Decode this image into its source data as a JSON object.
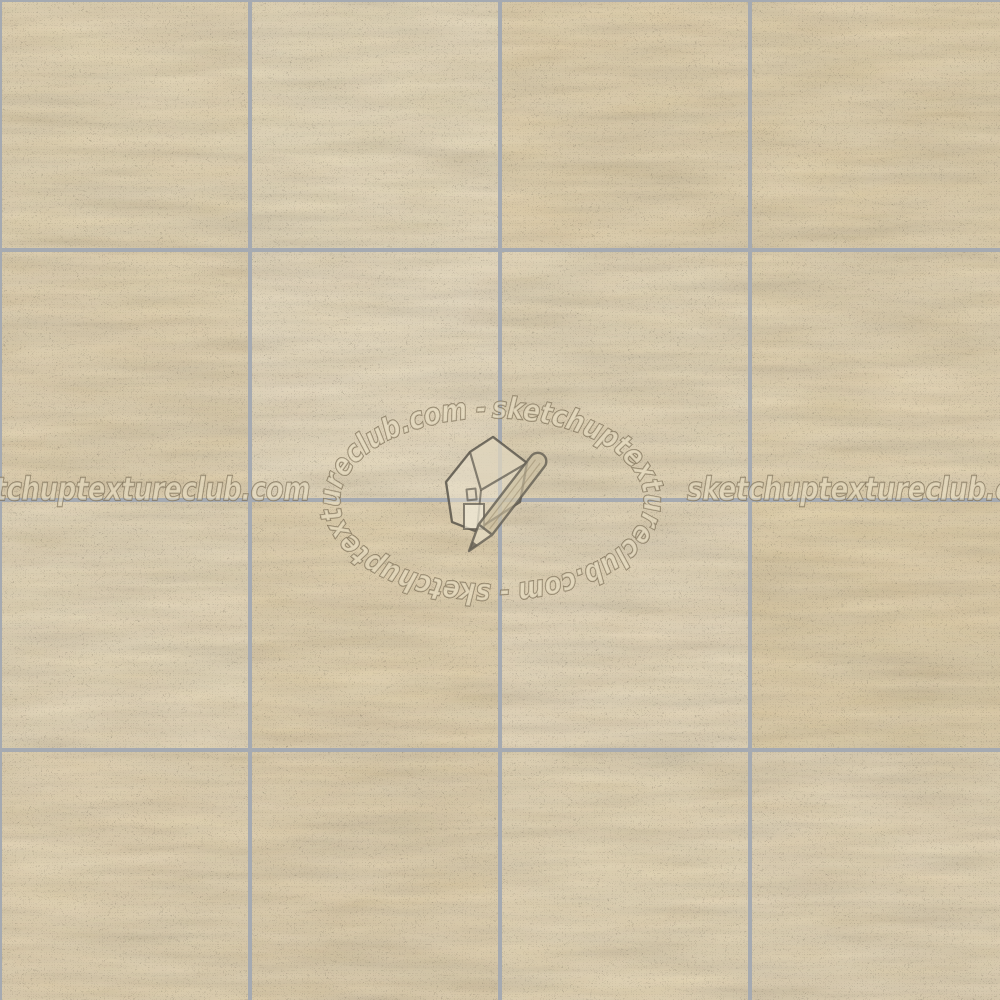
{
  "image": {
    "description": "Seamless travertine floor tiles texture, 4x4 grid of beige marble tiles with gray grout, watermarked by sketchuptextureclub.com",
    "grid": {
      "rows": 4,
      "cols": 4,
      "tile_size": 250,
      "grout_width": 4,
      "edge_top": 2,
      "edge_left": 2
    },
    "tile_tints": [
      "#e3d0a6",
      "#e6d5ae",
      "#e2cda0",
      "#e0cb9e",
      "#e1cda2",
      "#e7d6b2",
      "#e4d2aa",
      "#e3cfa4",
      "#e5d3ac",
      "#e1cca0",
      "#e6d4ae",
      "#dfc99a",
      "#e2cea4",
      "#e0cba0",
      "#e4d1a8",
      "#e3d0a8"
    ]
  },
  "watermark": {
    "site": "sketchuptextureclub.com",
    "horizontal_text": "sketchuptextureclub.com",
    "ellipse_text": "sketchuptextureclub.com - sketchuptextureclub.com -",
    "logo": "sketchup-house-and-pencil"
  },
  "palette": {
    "tile_base": "#e2cfa6",
    "tile_light_vein": "#f0e8d2",
    "tile_dark_vein": "#cdb586",
    "grout": "#a5aab1",
    "wm_fill": "#ece3c9",
    "wm_stroke": "#6e6049",
    "logo_fill": "#eee6d2",
    "logo_roof": "#e0d4ba",
    "logo_door": "#f2ecda",
    "logo_stroke": "#5a564c",
    "pencil_body": "#cdc0a2",
    "pencil_wood": "#e8dfc8",
    "pencil_lead": "#5f5b52"
  }
}
